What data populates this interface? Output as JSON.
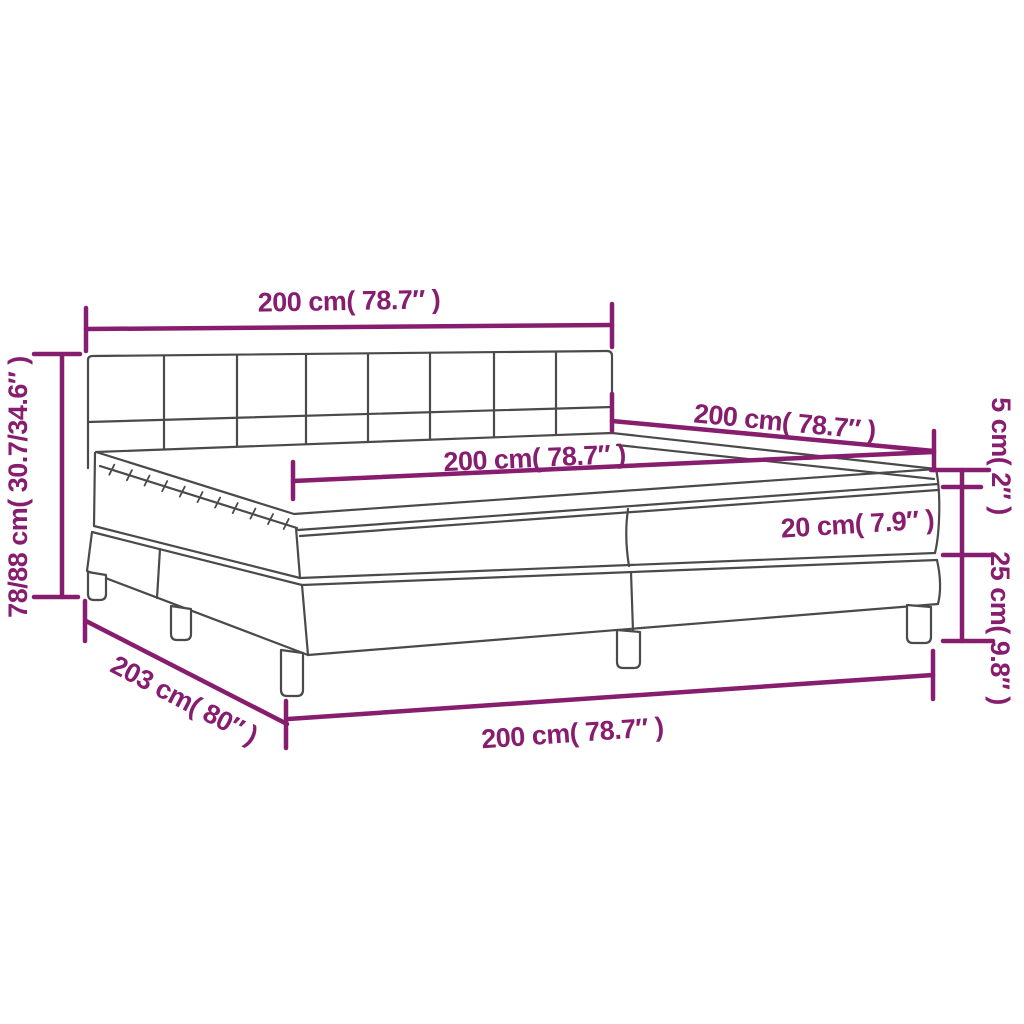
{
  "diagram": {
    "subject": "box-spring-bed-with-mattress",
    "colors": {
      "dimension_accent": "#871D6E",
      "outline": "#4A4A4A",
      "background": "#FFFFFF"
    },
    "labels": {
      "headboard_width": "200 cm( 78.7″ )",
      "bed_length_right": "200 cm( 78.7″ )",
      "mattress_width_top": "200 cm( 78.7″ )",
      "topper_height": "5 cm( 2″ )",
      "mattress_height": "20 cm( 7.9″ )",
      "base_height": "25 cm( 9.8″ )",
      "overall_height": "78/88 cm( 30.7/34.6″ )",
      "frame_length": "203 cm( 80″ )",
      "frame_width_front": "200 cm( 78.7″ )"
    }
  }
}
